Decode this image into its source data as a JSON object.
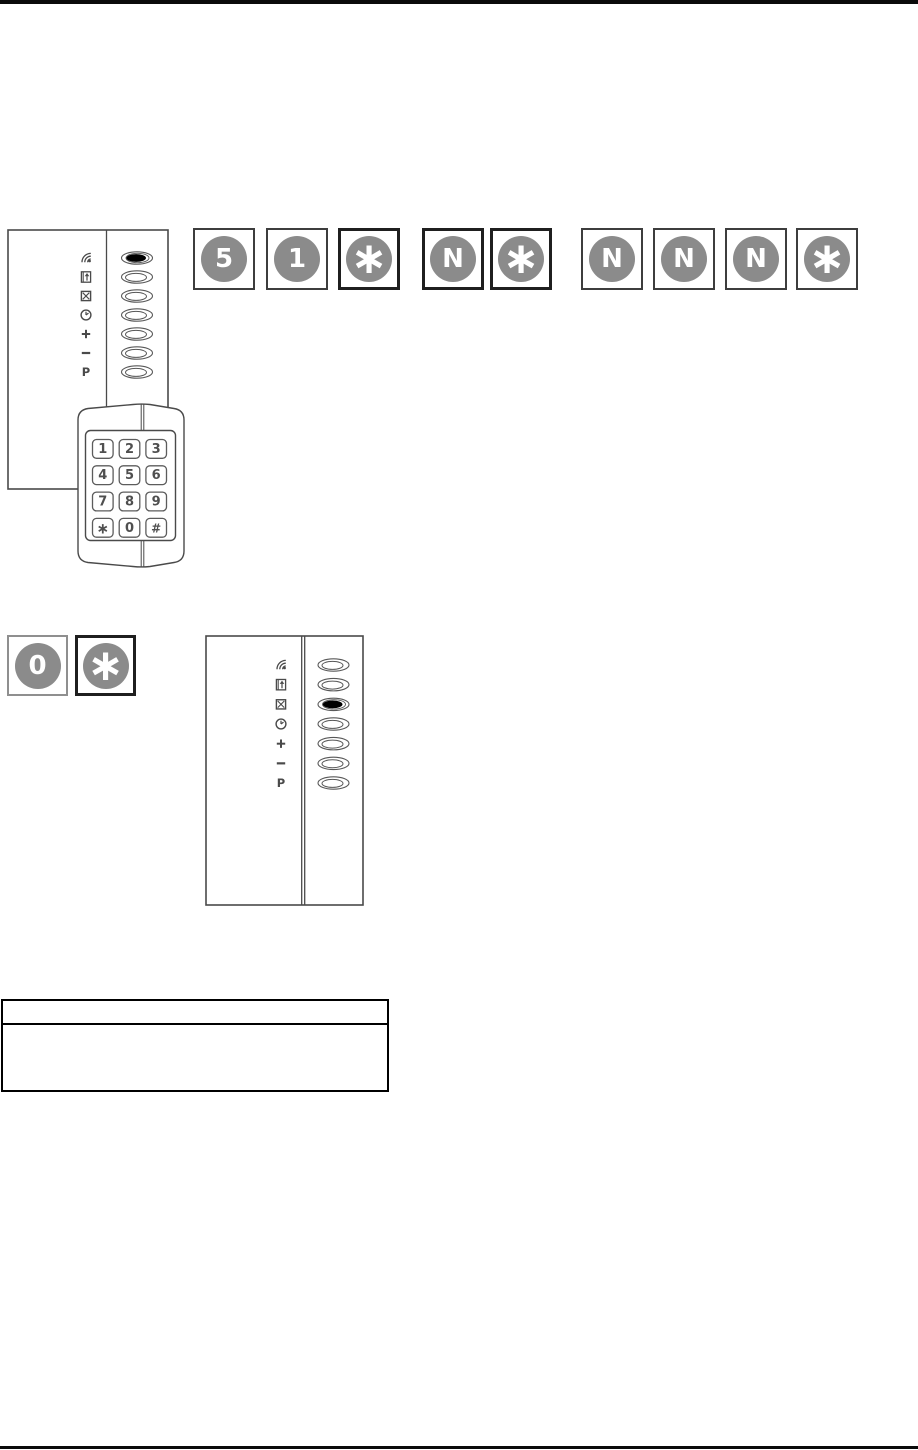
{
  "colors": {
    "rule": "#0a0a0a",
    "drawing_line": "#4a4a4a",
    "led_stroke": "#585858",
    "led_on_fill": "#000000",
    "key_circle": "#8b8b8b",
    "key_glyph": "#ffffff",
    "keypad_digit": "#4f4f4f"
  },
  "sequences": {
    "code_entry_part1": {
      "keys": [
        {
          "glyph": "5",
          "border": "normal"
        },
        {
          "glyph": "1",
          "border": "normal"
        },
        {
          "glyph": "*",
          "border": "dark"
        },
        {
          "glyph": "N",
          "border": "dark"
        },
        {
          "glyph": "*",
          "border": "dark"
        }
      ]
    },
    "code_entry_part2": {
      "keys": [
        {
          "glyph": "N",
          "border": "normal"
        },
        {
          "glyph": "N",
          "border": "normal"
        },
        {
          "glyph": "N",
          "border": "normal"
        },
        {
          "glyph": "*",
          "border": "normal"
        }
      ]
    },
    "exit_entry": {
      "keys": [
        {
          "glyph": "0",
          "border": "light"
        },
        {
          "glyph": "*",
          "border": "dark"
        }
      ]
    }
  },
  "reader_panel_top": {
    "rows": [
      {
        "icon": "signal-waves-icon",
        "led": "on"
      },
      {
        "icon": "door-enter-icon",
        "led": "off"
      },
      {
        "icon": "box-x-icon",
        "led": "off"
      },
      {
        "icon": "clock-icon",
        "led": "off"
      },
      {
        "icon": "plus-icon",
        "led": "off"
      },
      {
        "icon": "minus-icon",
        "led": "off"
      },
      {
        "icon": "letter-p-icon",
        "led": "off"
      }
    ],
    "last_led_override": "on"
  },
  "keypad": {
    "keys": [
      "1",
      "2",
      "3",
      "4",
      "5",
      "6",
      "7",
      "8",
      "9",
      "*",
      "0",
      "#"
    ]
  },
  "reader_panel_bottom": {
    "rows": [
      {
        "icon": "signal-waves-icon",
        "led": "off"
      },
      {
        "icon": "door-enter-icon",
        "led": "off"
      },
      {
        "icon": "box-x-icon",
        "led": "on"
      },
      {
        "icon": "clock-icon",
        "led": "off"
      },
      {
        "icon": "plus-icon",
        "led": "off"
      },
      {
        "icon": "minus-icon",
        "led": "off"
      },
      {
        "icon": "letter-p-icon",
        "led": "off"
      }
    ]
  },
  "notes_table": {
    "header": "",
    "body": ""
  }
}
